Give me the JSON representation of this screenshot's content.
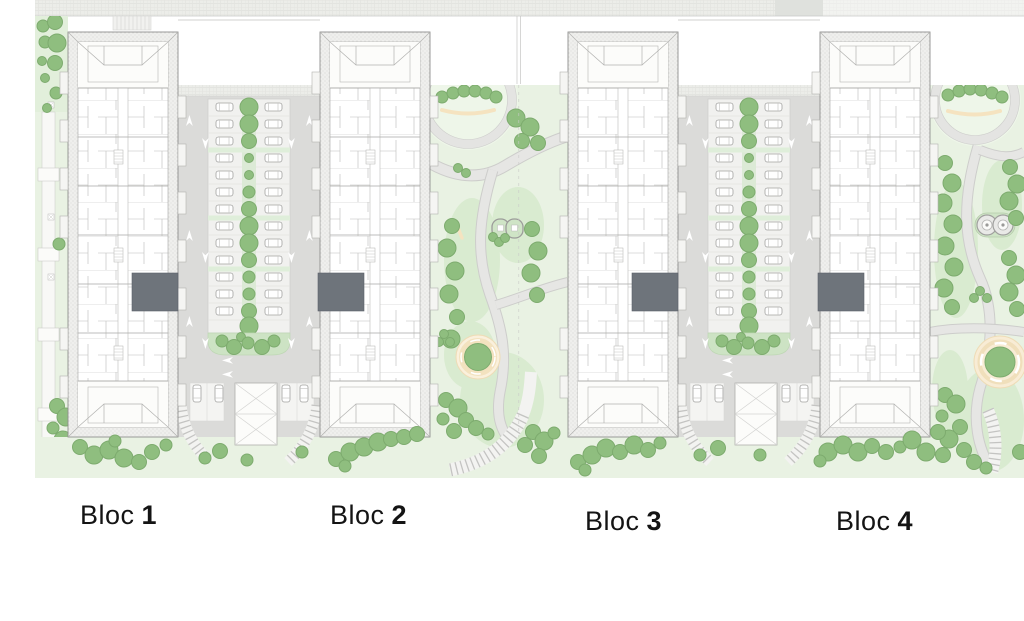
{
  "blocks": [
    {
      "word": "Bloc",
      "num": "1"
    },
    {
      "word": "Bloc",
      "num": "2"
    },
    {
      "word": "Bloc",
      "num": "3"
    },
    {
      "word": "Bloc",
      "num": "4"
    }
  ],
  "palette": {
    "lawn": "#e9f2e3",
    "lawn_shade": "#d9ebd0",
    "tree": "#8fbe7f",
    "asphalt": "#dbdbd9",
    "walkway": "#e6e6e4",
    "sand_accent": "#f5e3c0",
    "entrance_core": "#6e747b",
    "label_text": "#141414"
  },
  "icons": {
    "tree-icon": "green filled circle",
    "car-icon": "white rounded rectangle, top view",
    "direction-arrow-icon": "white lane arrow",
    "ramp-icon": "crossed white rectangle",
    "playground-icon": "double rounded rings",
    "plaza-icon": "sand ring with center tree",
    "bench-icon": "short sand strip",
    "lamp-icon": "small crossed square"
  }
}
